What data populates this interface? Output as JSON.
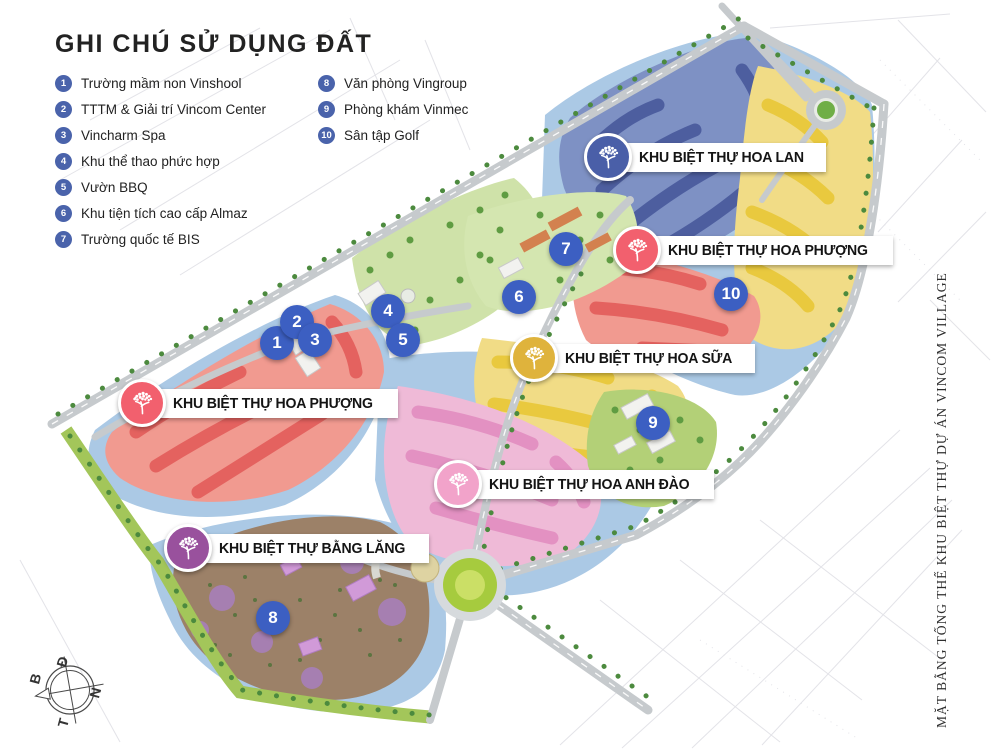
{
  "legend": {
    "title": "GHI CHÚ SỬ DỤNG ĐẤT",
    "dot_color": "#4a63ab",
    "items": [
      {
        "number": "1",
        "label": "Trường mầm non Vinshool"
      },
      {
        "number": "2",
        "label": "TTTM & Giải trí Vincom Center"
      },
      {
        "number": "3",
        "label": "Vincharm Spa"
      },
      {
        "number": "4",
        "label": "Khu thể thao phức hợp"
      },
      {
        "number": "5",
        "label": "Vườn BBQ"
      },
      {
        "number": "6",
        "label": "Khu tiện tích cao cấp Almaz"
      },
      {
        "number": "7",
        "label": "Trường quốc tế BIS"
      },
      {
        "number": "8",
        "label": "Văn phòng Vingroup"
      },
      {
        "number": "9",
        "label": "Phòng khám Vinmec"
      },
      {
        "number": "10",
        "label": "Sân tập Golf"
      }
    ]
  },
  "map": {
    "marker_color": "#3c5fc2",
    "markers": [
      {
        "number": "1"
      },
      {
        "number": "2"
      },
      {
        "number": "3"
      },
      {
        "number": "4"
      },
      {
        "number": "5"
      },
      {
        "number": "6"
      },
      {
        "number": "7"
      },
      {
        "number": "8"
      },
      {
        "number": "9"
      },
      {
        "number": "10"
      }
    ],
    "zone_labels": [
      {
        "name": "KHU BIỆT THỰ HOA LAN",
        "color": "#4a5fa8"
      },
      {
        "name": "KHU BIỆT THỰ HOA PHƯỢNG",
        "color": "#f2606e"
      },
      {
        "name": "KHU BIỆT THỰ HOA SỮA",
        "color": "#dfb33c"
      },
      {
        "name": "KHU BIỆT THỰ HOA ANH ĐÀO",
        "color": "#f2a3ca"
      },
      {
        "name": "KHU BIỆT THỰ BẰNG LĂNG",
        "color": "#99519d"
      },
      {
        "name": "KHU BIỆT THỰ HOA PHƯỢNG",
        "color": "#f2606e"
      }
    ]
  },
  "compass": {
    "east": "Đ",
    "north": "B",
    "south": "N",
    "west": "T"
  },
  "side_caption": "MẶT BẰNG TỔNG THỂ KHU BIỆT THỰ DỰ ÁN VINCOM VILLAGE"
}
